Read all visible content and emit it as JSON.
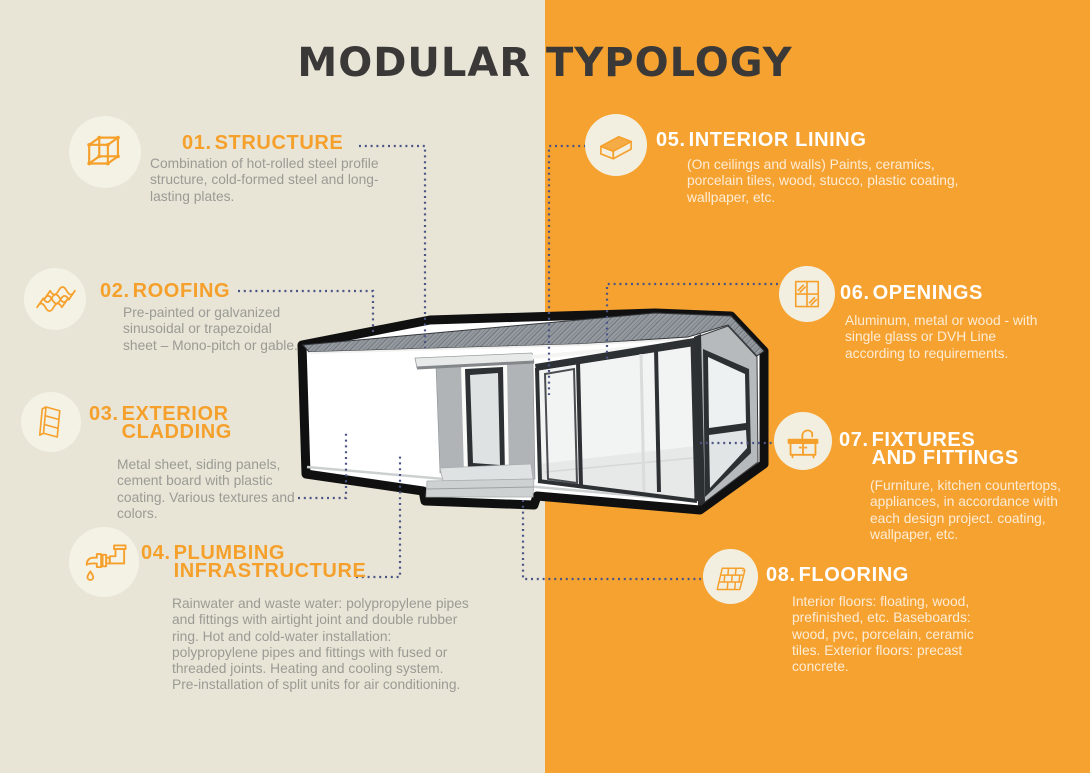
{
  "title": "MODULAR TYPOLOGY",
  "theme": {
    "bg_left": "#e8e5d6",
    "bg_right": "#f6a230",
    "accent_orange": "#f6a02c",
    "title_color": "#3a3938",
    "body_text_left": "#9b9a95",
    "body_text_right": "rgba(255,255,255,0.8)",
    "connector_color": "#4b5585",
    "circle_left": "#f4f2e5",
    "circle_right": "#f2efe1"
  },
  "sections": [
    {
      "num": "01.",
      "title1": "STRUCTURE",
      "title2": "",
      "body": "Combination of hot-rolled steel profile structure, cold-formed steel and long-lasting plates.",
      "icon": "cube-structure-icon"
    },
    {
      "num": "02.",
      "title1": "ROOFING",
      "title2": "",
      "body": "Pre-painted or galvanized sinusoidal or trapezoidal sheet – Mono-pitch or gable.",
      "icon": "roof-sheet-icon"
    },
    {
      "num": "03.",
      "title1": "EXTERIOR",
      "title2": "CLADDING",
      "body": "Metal sheet, siding panels, cement board with plastic coating. Various textures and colors.",
      "icon": "cladding-panels-icon"
    },
    {
      "num": "04.",
      "title1": "PLUMBING",
      "title2": "INFRASTRUCTURE",
      "body": "Rainwater and waste water: polypropylene pipes and fittings with airtight joint and double rubber ring. Hot and cold-water installation: polypropylene pipes and fittings with fused or threaded joints. Heating and cooling system. Pre-installation of split units for air conditioning.",
      "icon": "plumbing-pipe-icon"
    },
    {
      "num": "05.",
      "title1": "INTERIOR LINING",
      "title2": "",
      "body": "(On ceilings and walls) Paints, ceramics, porcelain tiles, wood, stucco, plastic coating, wallpaper, etc.",
      "icon": "wall-panel-icon"
    },
    {
      "num": "06.",
      "title1": "OPENINGS",
      "title2": "",
      "body": "Aluminum, metal or wood - with single glass or DVH Line according to requirements.",
      "icon": "window-icon"
    },
    {
      "num": "07.",
      "title1": "FIXTURES",
      "title2": "AND FITTINGS",
      "body": "(Furniture, kitchen countertops, appliances, in accordance with each design project. coating, wallpaper, etc.",
      "icon": "sink-icon"
    },
    {
      "num": "08.",
      "title1": "FLOORING",
      "title2": "",
      "body": "Interior floors: floating, wood, prefinished, etc. Baseboards: wood, pvc, porcelain, ceramic tiles. Exterior floors: precast concrete.",
      "icon": "floor-planks-icon"
    }
  ]
}
